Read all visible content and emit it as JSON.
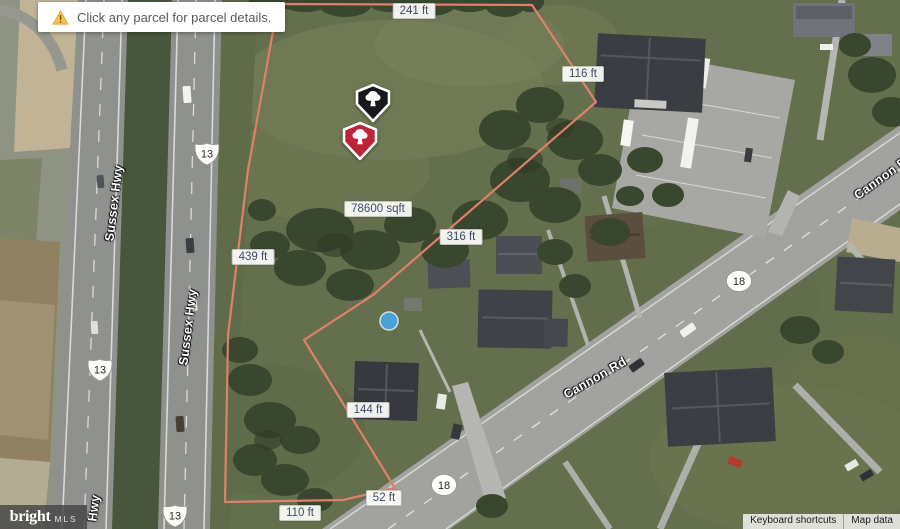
{
  "banner": {
    "icon": "warning-triangle",
    "text": "Click any parcel for parcel details."
  },
  "parcel": {
    "area": "78600 sqft",
    "dimensions": [
      "241 ft",
      "116 ft",
      "316 ft",
      "439 ft",
      "144 ft",
      "52 ft",
      "110 ft"
    ],
    "outline_color": "#e0806a"
  },
  "roads": {
    "sussex_hwy": "Sussex Hwy",
    "sussex_hwy_partial": "Hwy",
    "cannon_rd": "Cannon Rd",
    "us_route": "13",
    "state_route": "18"
  },
  "markers": [
    {
      "id": "black-tree-marker",
      "color": "#17171b"
    },
    {
      "id": "red-tree-marker",
      "color": "#bd2438"
    }
  ],
  "logo": {
    "brand": "bright",
    "suffix": "MLS"
  },
  "attribution": {
    "keyboard_shortcuts": "Keyboard shortcuts",
    "map_data": "Map data"
  }
}
